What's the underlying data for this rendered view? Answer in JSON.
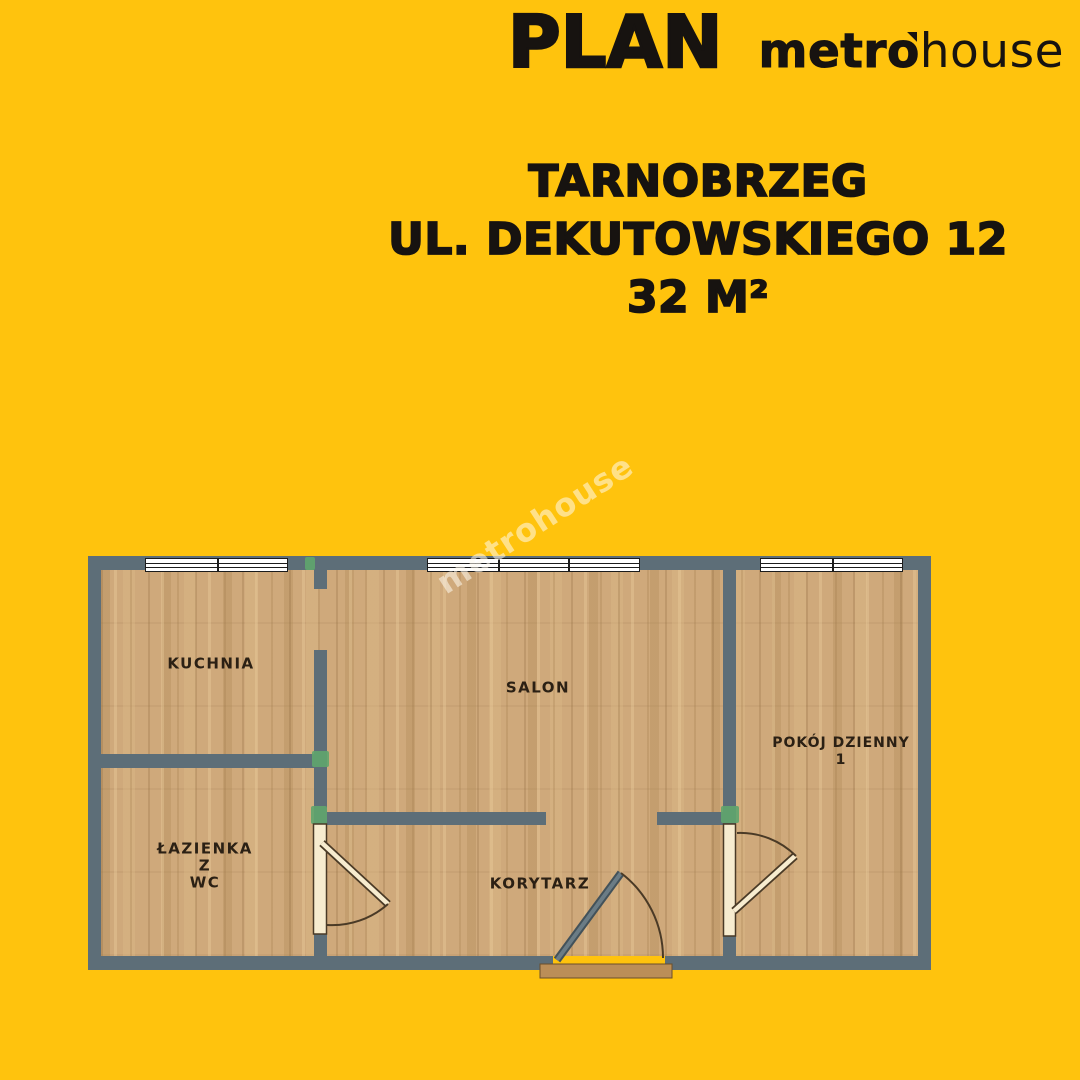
{
  "header": {
    "plan": "PLAN",
    "brand_metro": "metr",
    "brand_o": "o",
    "brand_house": "house"
  },
  "address": {
    "city": "TARNOBRZEG",
    "street": "UL. DEKUTOWSKIEGO 12",
    "area": "32 M²"
  },
  "watermark": {
    "text": "metrohouse"
  },
  "floorplan": {
    "rooms": [
      {
        "id": "kuchnia",
        "label": "KUCHNIA"
      },
      {
        "id": "salon",
        "label": "SALON"
      },
      {
        "id": "pokoj-dzienny",
        "label": "POKÓJ DZIENNY",
        "number": "1"
      },
      {
        "id": "lazienka",
        "line1": "ŁAZIENKA",
        "line2": "Z",
        "line3": "WC"
      },
      {
        "id": "korytarz",
        "label": "KORYTARZ"
      }
    ]
  },
  "colors": {
    "bg": "#ffc30d",
    "wall": "#5d6e78",
    "floor": "#cfa97b",
    "door": "#f7eccf",
    "door_border": "#4a3a26",
    "threshold": "#bb8e58",
    "threshold_border": "#6b4f2a",
    "window": "#ffffff",
    "line": "#1c1c1c",
    "text": "#171310",
    "label": "#2b2014",
    "green": "#5fa56d",
    "entry_door": "#6b7c85",
    "entry_door_edge": "#43525a",
    "watermark": "rgba(255,250,238,0.55)"
  }
}
